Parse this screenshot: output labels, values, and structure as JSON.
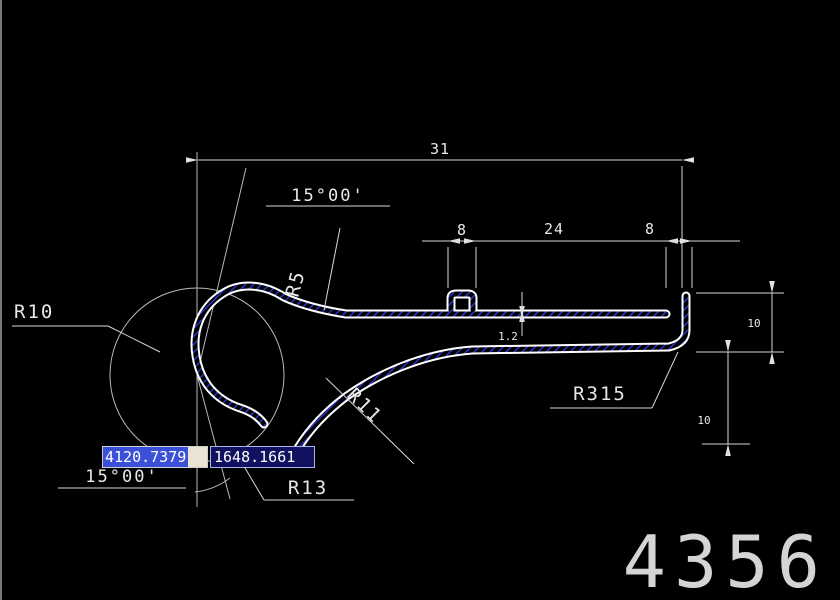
{
  "drawing": {
    "dims": {
      "total_width": "31",
      "tab_width": "8",
      "middle_width": "24",
      "lip_width": "8",
      "height_upper": "10",
      "height_lower": "10",
      "wall_thickness": "1.2"
    },
    "angles": {
      "top": "15°00'",
      "bottom": "15°00'"
    },
    "radii": {
      "r10": "R10",
      "r5": "R5",
      "r11": "R11",
      "r13": "R13",
      "r315": "R315"
    }
  },
  "dynamic_input": {
    "x_value": "4120.7379",
    "y_value": "1648.1661"
  },
  "sheet": {
    "number": "4356"
  },
  "colors": {
    "line": "#ffffff",
    "dim": "#d9d9d9",
    "hatch": "#2a35c8",
    "highlight": "#3b4fd8"
  }
}
